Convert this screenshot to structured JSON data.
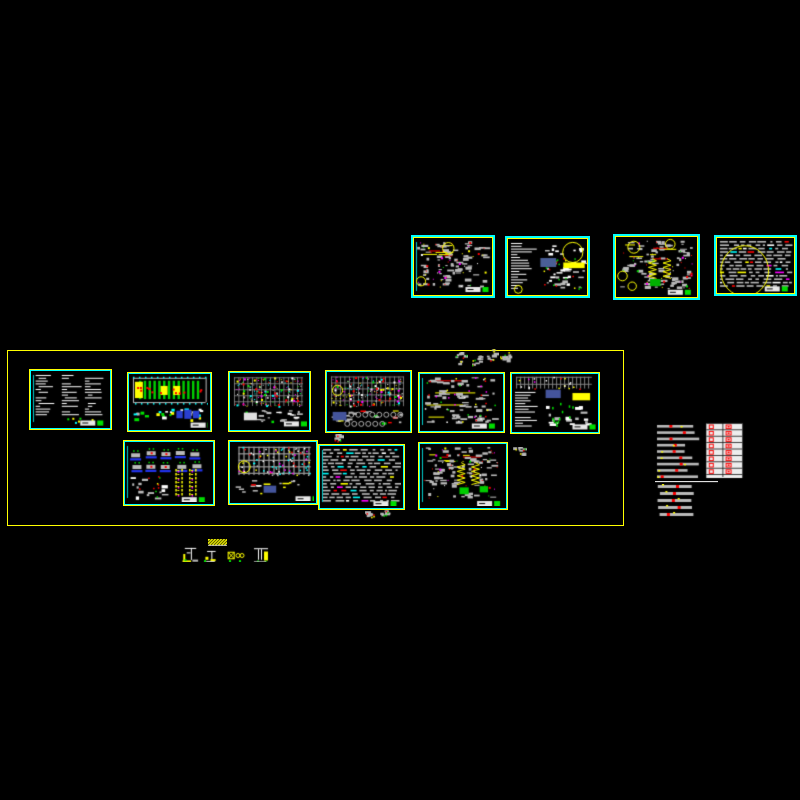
{
  "document": {
    "type": "cad-model-space",
    "background": "#000000",
    "sheet_count": 15
  },
  "colors": {
    "gray": "#b9b9b9",
    "red": "#ff0000",
    "yellow": "#ffff00",
    "green": "#00e000",
    "magenta": "#ff00ff",
    "cyan": "#00ffff",
    "white": "#ffffff",
    "steel_blue": "#44549c",
    "bright_blue": "#2233ee",
    "frame_yellow": "#ffff00",
    "frame_cyan": "#00ffff"
  },
  "layout_frame": {
    "x": 7,
    "y": 350,
    "w": 617,
    "h": 176
  },
  "sheets": [
    {
      "id": "t1",
      "x": 411,
      "y": 235,
      "w": 84,
      "h": 63,
      "frame": "cyan",
      "kind": "details",
      "seed": 11,
      "features": [
        {
          "t": "leftstrip"
        },
        {
          "t": "circle",
          "x": 0.44,
          "y": 0.18,
          "r": 0.1
        },
        {
          "t": "circle",
          "x": 0.09,
          "y": 0.76,
          "r": 0.08
        },
        {
          "t": "stamp",
          "x": 0.66,
          "y": 0.86
        }
      ]
    },
    {
      "id": "t2",
      "x": 505,
      "y": 236,
      "w": 85,
      "h": 62,
      "frame": "cyan",
      "kind": "notesdetails",
      "seed": 22,
      "features": [
        {
          "t": "rect",
          "x": 0.41,
          "y": 0.34,
          "w": 0.2,
          "h": 0.16,
          "c": "#4a5f96"
        },
        {
          "t": "rect",
          "x": 0.7,
          "y": 0.42,
          "w": 0.27,
          "h": 0.1,
          "c": "#ffff00"
        },
        {
          "t": "circle",
          "x": 0.82,
          "y": 0.24,
          "r": 0.18
        },
        {
          "t": "circle",
          "x": 0.13,
          "y": 0.9,
          "r": 0.07
        }
      ]
    },
    {
      "id": "t3",
      "x": 613,
      "y": 234,
      "w": 87,
      "h": 66,
      "frame": "cyan",
      "kind": "details",
      "seed": 33,
      "features": [
        {
          "t": "spring",
          "x": 0.45,
          "y": 0.36,
          "l": 0.3
        },
        {
          "t": "spring",
          "x": 0.63,
          "y": 0.36,
          "l": 0.3
        },
        {
          "t": "circle",
          "x": 0.22,
          "y": 0.17,
          "r": 0.1
        },
        {
          "t": "circle",
          "x": 0.67,
          "y": 0.12,
          "r": 0.08
        },
        {
          "t": "circle",
          "x": 0.08,
          "y": 0.65,
          "r": 0.08
        },
        {
          "t": "circle",
          "x": 0.2,
          "y": 0.82,
          "r": 0.07
        },
        {
          "t": "rect",
          "x": 0.42,
          "y": 0.7,
          "w": 0.13,
          "h": 0.12,
          "c": "#00b000"
        },
        {
          "t": "stamp",
          "x": 0.64,
          "y": 0.88
        }
      ]
    },
    {
      "id": "t4",
      "x": 714,
      "y": 235,
      "w": 83,
      "h": 61,
      "frame": "cyan",
      "kind": "denserows",
      "seed": 44,
      "features": [
        {
          "t": "ellipse",
          "x": 0.36,
          "y": 0.6,
          "rx": 0.31,
          "ry": 0.46
        },
        {
          "t": "stamp",
          "x": 0.62,
          "y": 0.88
        }
      ]
    },
    {
      "id": "m1",
      "x": 29,
      "y": 369,
      "w": 83,
      "h": 61,
      "frame": "yellow",
      "kind": "notes",
      "seed": 55,
      "features": [
        {
          "t": "leftstrip"
        },
        {
          "t": "stamp",
          "x": 0.64,
          "y": 0.9
        }
      ]
    },
    {
      "id": "m2",
      "x": 127,
      "y": 372,
      "w": 85,
      "h": 60,
      "frame": "yellow",
      "kind": "greenplan",
      "seed": 66,
      "features": [
        {
          "t": "rect",
          "x": 0.6,
          "y": 0.68,
          "w": 0.08,
          "h": 0.14,
          "c": "#2a3fd0"
        },
        {
          "t": "rect",
          "x": 0.7,
          "y": 0.66,
          "w": 0.09,
          "h": 0.17,
          "c": "#2a3fd0"
        },
        {
          "t": "rect",
          "x": 0.81,
          "y": 0.68,
          "w": 0.08,
          "h": 0.14,
          "c": "#2a3fd0"
        },
        {
          "t": "stamp",
          "x": 0.78,
          "y": 0.9
        }
      ]
    },
    {
      "id": "m3",
      "x": 228,
      "y": 371,
      "w": 83,
      "h": 61,
      "frame": "yellow",
      "kind": "plan",
      "seed": 77,
      "features": [
        {
          "t": "rect",
          "x": 0.18,
          "y": 0.72,
          "w": 0.17,
          "h": 0.14,
          "c": "#e0e0e0"
        },
        {
          "t": "stamp",
          "x": 0.7,
          "y": 0.88
        }
      ]
    },
    {
      "id": "m4",
      "x": 325,
      "y": 370,
      "w": 87,
      "h": 63,
      "frame": "yellow",
      "kind": "plan",
      "seed": 88,
      "features": [
        {
          "t": "circle",
          "x": 0.13,
          "y": 0.32,
          "r": 0.09
        },
        {
          "t": "rect",
          "x": 0.07,
          "y": 0.7,
          "w": 0.17,
          "h": 0.15,
          "c": "#44549c"
        },
        {
          "t": "circlerow",
          "x": 0.3,
          "y": 0.75,
          "l": 0.64
        },
        {
          "t": "circlerow",
          "x": 0.25,
          "y": 0.91,
          "l": 0.46
        }
      ]
    },
    {
      "id": "m5",
      "x": 418,
      "y": 372,
      "w": 87,
      "h": 61,
      "frame": "yellow",
      "kind": "detailrows",
      "seed": 99,
      "features": [
        {
          "t": "leftstrip"
        },
        {
          "t": "stamp",
          "x": 0.64,
          "y": 0.9
        }
      ]
    },
    {
      "id": "m6",
      "x": 510,
      "y": 372,
      "w": 90,
      "h": 62,
      "frame": "yellow",
      "kind": "mixed",
      "seed": 110,
      "features": [
        {
          "t": "rect",
          "x": 0.4,
          "y": 0.28,
          "w": 0.18,
          "h": 0.15,
          "c": "#44549c"
        },
        {
          "t": "rect",
          "x": 0.72,
          "y": 0.34,
          "w": 0.21,
          "h": 0.13,
          "c": "#ffff00"
        },
        {
          "t": "stamp",
          "x": 0.72,
          "y": 0.9
        }
      ]
    },
    {
      "id": "b1",
      "x": 123,
      "y": 440,
      "w": 92,
      "h": 66,
      "frame": "yellow",
      "kind": "bluedetails",
      "seed": 121,
      "features": [
        {
          "t": "leftstrip"
        },
        {
          "t": "ladder",
          "x": 0.62,
          "y": 0.45,
          "l": 0.44
        },
        {
          "t": "ladder",
          "x": 0.78,
          "y": 0.45,
          "l": 0.44
        },
        {
          "t": "stamp",
          "x": 0.66,
          "y": 0.92
        }
      ]
    },
    {
      "id": "b2",
      "x": 228,
      "y": 440,
      "w": 90,
      "h": 65,
      "frame": "yellow",
      "kind": "plan2",
      "seed": 132,
      "features": [
        {
          "t": "circle",
          "x": 0.17,
          "y": 0.42,
          "r": 0.1
        },
        {
          "t": "rect",
          "x": 0.4,
          "y": 0.74,
          "w": 0.15,
          "h": 0.12,
          "c": "#44549c"
        },
        {
          "t": "stamp",
          "x": 0.78,
          "y": 0.92
        }
      ]
    },
    {
      "id": "b3",
      "x": 318,
      "y": 444,
      "w": 87,
      "h": 66,
      "frame": "yellow",
      "kind": "denserows",
      "seed": 143,
      "features": [
        {
          "t": "leftstrip"
        },
        {
          "t": "stamp",
          "x": 0.66,
          "y": 0.92
        }
      ]
    },
    {
      "id": "b4",
      "x": 418,
      "y": 442,
      "w": 90,
      "h": 68,
      "frame": "yellow",
      "kind": "details",
      "seed": 154,
      "features": [
        {
          "t": "leftstrip"
        },
        {
          "t": "spring",
          "x": 0.49,
          "y": 0.3,
          "l": 0.32
        },
        {
          "t": "spring",
          "x": 0.66,
          "y": 0.3,
          "l": 0.32
        },
        {
          "t": "rect",
          "x": 0.47,
          "y": 0.7,
          "w": 0.11,
          "h": 0.11,
          "c": "#00cc00"
        },
        {
          "t": "rect",
          "x": 0.71,
          "y": 0.68,
          "w": 0.1,
          "h": 0.1,
          "c": "#00cc00"
        },
        {
          "t": "stamp",
          "x": 0.68,
          "y": 0.92
        }
      ]
    },
    {
      "id": "r1",
      "x": 655,
      "y": 422,
      "w": 90,
      "h": 62,
      "frame": "none",
      "kind": "redtable",
      "seed": 165,
      "features": []
    }
  ],
  "fragments": [
    {
      "id": "f1",
      "x": 454,
      "y": 352,
      "w": 14,
      "h": 14,
      "kind": "specks",
      "seed": 1
    },
    {
      "id": "f2",
      "x": 472,
      "y": 355,
      "w": 12,
      "h": 12,
      "kind": "specks",
      "seed": 2
    },
    {
      "id": "f3",
      "x": 484,
      "y": 349,
      "w": 15,
      "h": 15,
      "kind": "specks",
      "seed": 3
    },
    {
      "id": "f4",
      "x": 500,
      "y": 351,
      "w": 13,
      "h": 13,
      "kind": "specks",
      "seed": 4
    },
    {
      "id": "f5",
      "x": 334,
      "y": 434,
      "w": 10,
      "h": 9,
      "kind": "specks",
      "seed": 5
    },
    {
      "id": "f6",
      "x": 513,
      "y": 447,
      "w": 14,
      "h": 9,
      "kind": "specks",
      "seed": 6
    },
    {
      "id": "f7",
      "x": 365,
      "y": 511,
      "w": 11,
      "h": 8,
      "kind": "specks",
      "seed": 7
    },
    {
      "id": "f8",
      "x": 380,
      "y": 510,
      "w": 13,
      "h": 9,
      "kind": "specks",
      "seed": 8
    },
    {
      "id": "r1-tail",
      "x": 655,
      "y": 484,
      "w": 47,
      "h": 39,
      "kind": "graystack",
      "seed": 9
    },
    {
      "id": "r1-line",
      "x": 655,
      "y": 481,
      "w": 63,
      "h": 2,
      "kind": "hline",
      "seed": 10
    }
  ],
  "legend": {
    "bar": {
      "id": "legend-hatch-bar",
      "x": 208,
      "y": 539,
      "w": 19,
      "h": 7,
      "kind": "legendbar"
    },
    "items": [
      {
        "id": "legend-detail-1",
        "x": 181,
        "y": 546,
        "w": 19,
        "h": 16,
        "kind": "legend1"
      },
      {
        "id": "legend-detail-2",
        "x": 202,
        "y": 549,
        "w": 17,
        "h": 13,
        "kind": "legend2"
      },
      {
        "id": "legend-detail-3",
        "x": 227,
        "y": 549,
        "w": 20,
        "h": 13,
        "kind": "legend3"
      },
      {
        "id": "legend-detail-4",
        "x": 251,
        "y": 547,
        "w": 20,
        "h": 15,
        "kind": "legend4"
      }
    ]
  }
}
